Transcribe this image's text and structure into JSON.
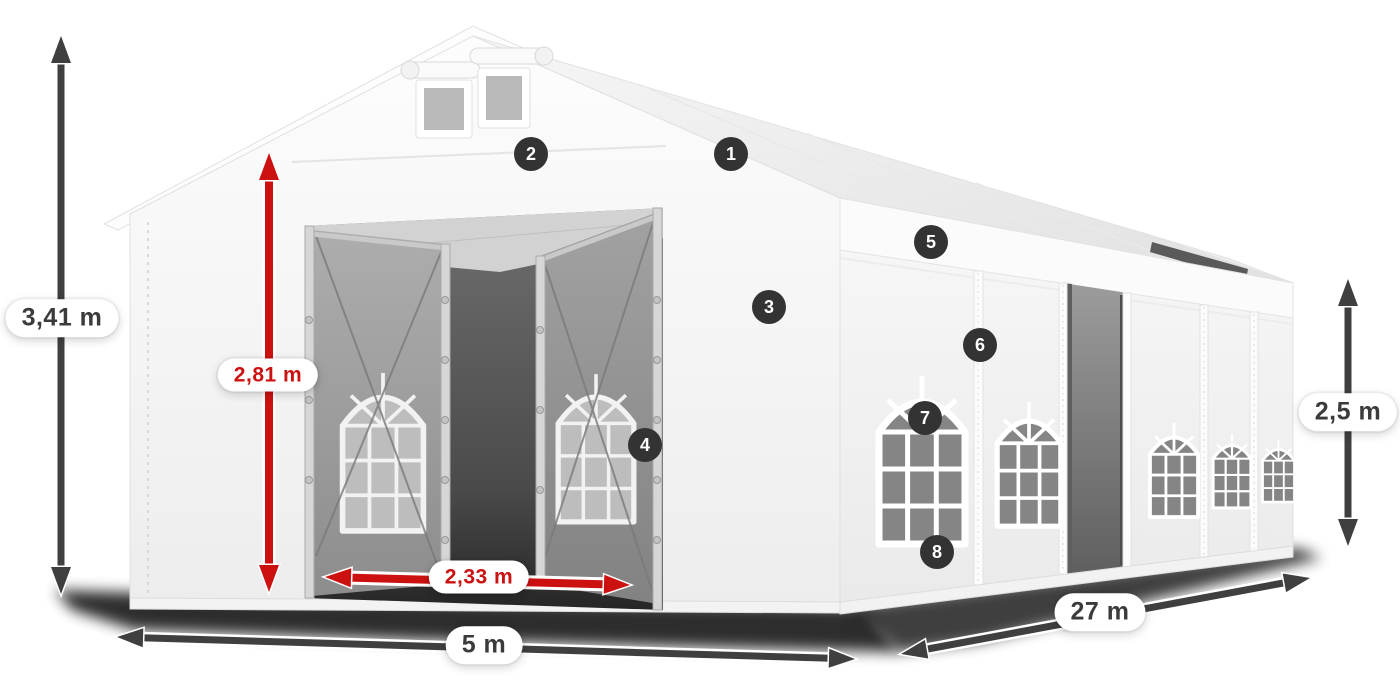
{
  "illustration": {
    "subject": "White marquee tent shown in three-quarter perspective with gable front, two open front doors and arched side windows"
  },
  "colors": {
    "dimension_red": "#cc1111",
    "dimension_gray": "#3f3f3f",
    "hotspot_background": "#333333",
    "hotspot_text": "#ffffff",
    "label_background": "#ffffff"
  },
  "dimensions": {
    "total_height": {
      "value": "3,41 m",
      "color": "gray"
    },
    "inner_height": {
      "value": "2,81 m",
      "color": "red"
    },
    "door_width": {
      "value": "2,33 m",
      "color": "red"
    },
    "front_width": {
      "value": "5 m",
      "color": "gray"
    },
    "side_length": {
      "value": "27 m",
      "color": "gray"
    },
    "side_height": {
      "value": "2,5 m",
      "color": "gray"
    }
  },
  "hotspots": [
    {
      "number": "1"
    },
    {
      "number": "2"
    },
    {
      "number": "3"
    },
    {
      "number": "4"
    },
    {
      "number": "5"
    },
    {
      "number": "6"
    },
    {
      "number": "7"
    },
    {
      "number": "8"
    }
  ]
}
